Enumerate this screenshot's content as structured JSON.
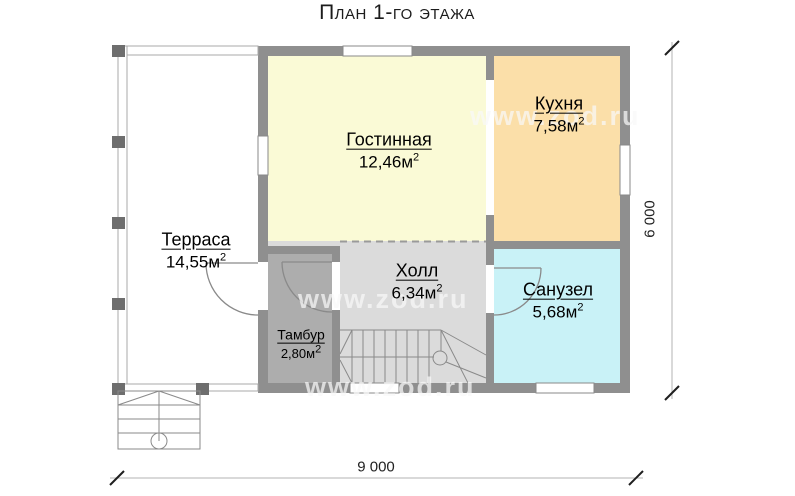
{
  "title": "План 1-го этажа",
  "watermark": {
    "text": "www.zod.ru"
  },
  "rooms": {
    "terrace": {
      "name": "Терраса",
      "area": "14,55м",
      "sup": "2"
    },
    "living": {
      "name": "Гостинная",
      "area": "12,46м",
      "sup": "2"
    },
    "kitchen": {
      "name": "Кухня",
      "area": "7,58м",
      "sup": "2"
    },
    "hall": {
      "name": "Холл",
      "area": "6,34м",
      "sup": "2"
    },
    "tambour": {
      "name": "Тамбур",
      "area": "2,80м",
      "sup": "2"
    },
    "bathroom": {
      "name": "Санузел",
      "area": "5,68м",
      "sup": "2"
    }
  },
  "dimensions": {
    "width": "9 000",
    "height": "6 000"
  },
  "colors": {
    "living": "#FAFAD6",
    "kitchen": "#FBDFA9",
    "hall": "#DBDBDB",
    "tambour": "#ADADAD",
    "bathroom": "#C9F2F7",
    "wall": "#8F8F8F",
    "column": "#6E6E6E"
  }
}
